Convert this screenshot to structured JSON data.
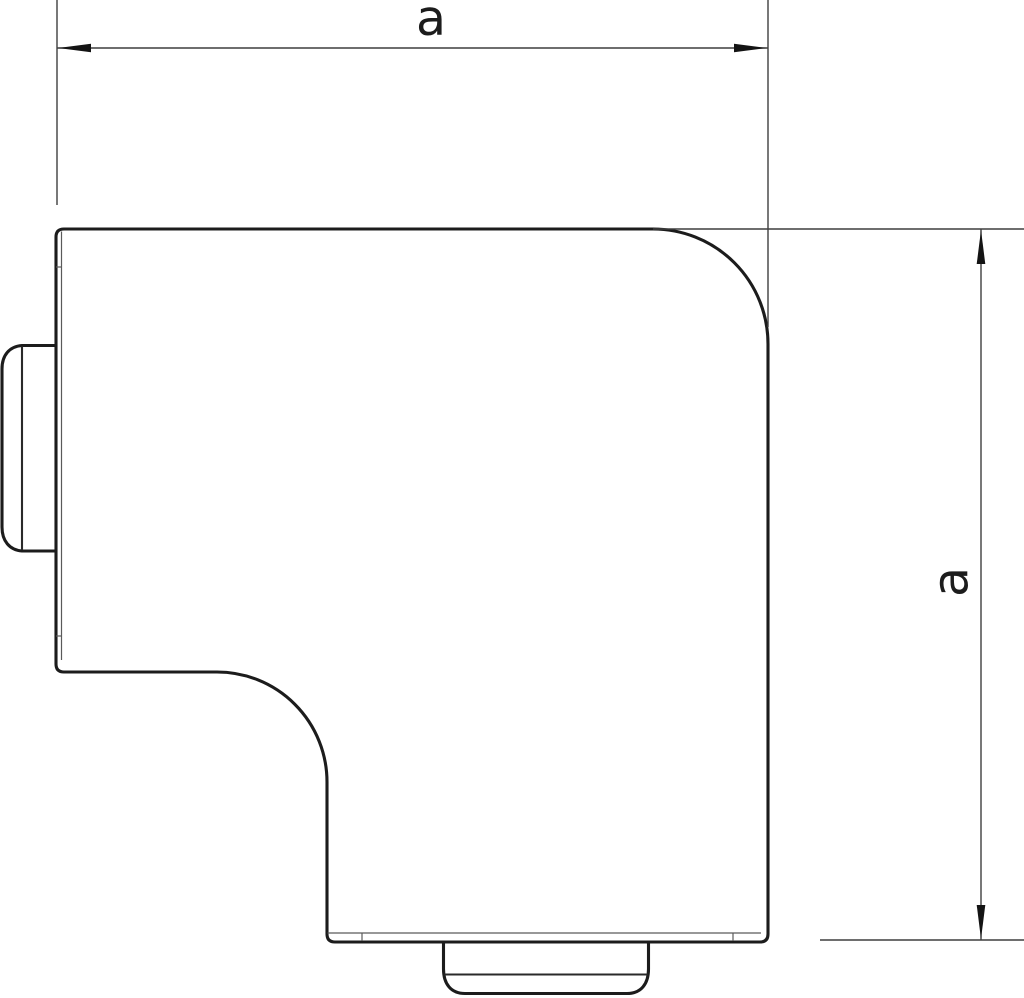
{
  "dimensions": {
    "horizontal": {
      "label": "a"
    },
    "vertical": {
      "label": "a"
    }
  },
  "colors": {
    "background": "#ffffff",
    "outline": "#1c1c1c",
    "face_line": "#2a2a2a",
    "inner_line": "#5a5a5a",
    "dimension_line": "#3f3f3f",
    "arrow_fill": "#141414",
    "label": "#1c1c1c"
  }
}
